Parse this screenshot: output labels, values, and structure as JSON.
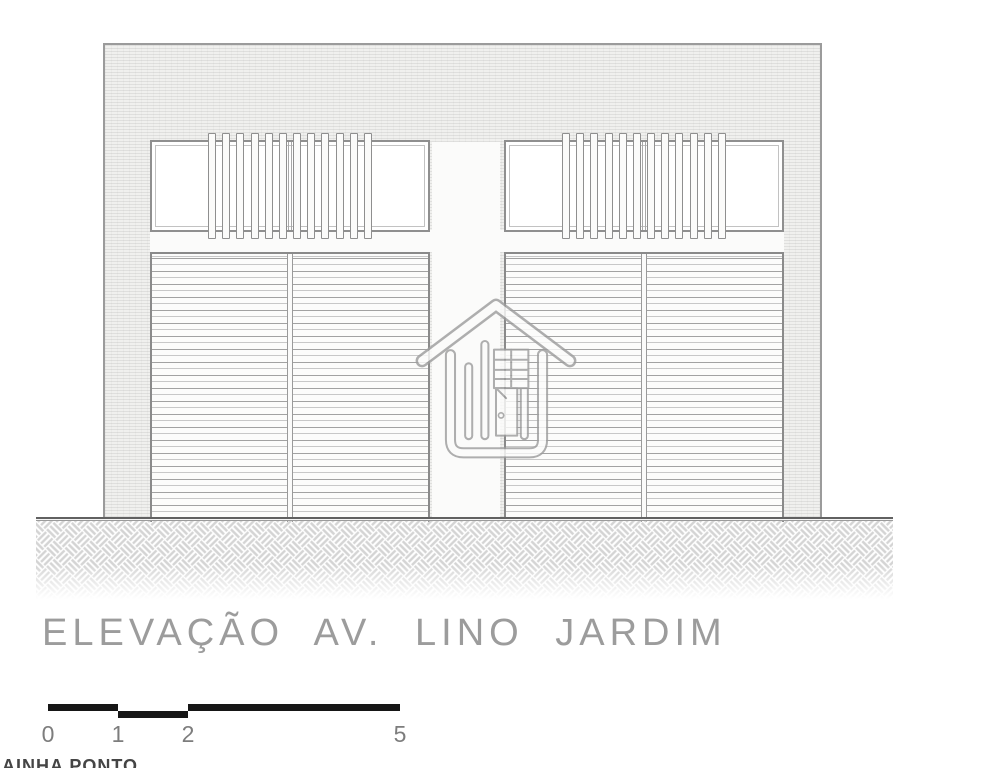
{
  "drawing": {
    "title": "ELEVAÇÃO AV. LINO JARDIM",
    "scale_bar": {
      "labels": [
        "0",
        "1",
        "2",
        "5"
      ]
    },
    "watermark": {
      "icon": "house-logo-icon",
      "clipped_text": "AINHA PONTO"
    },
    "facade": {
      "bays": [
        {
          "id": "left",
          "slat_count": 12,
          "door_panels": 2
        },
        {
          "id": "right",
          "slat_count": 12,
          "door_panels": 2
        }
      ]
    },
    "colors": {
      "frame_line": "#8f8f8f",
      "wall_fill": "#f0f0ee",
      "door_line": "#a2a2a2",
      "ground_line": "#616161",
      "hatch_line": "#d4d4d4",
      "title_text": "#9c9c9c",
      "scale_bar": "#161616",
      "watermark_line": "#9e9e9e"
    }
  }
}
